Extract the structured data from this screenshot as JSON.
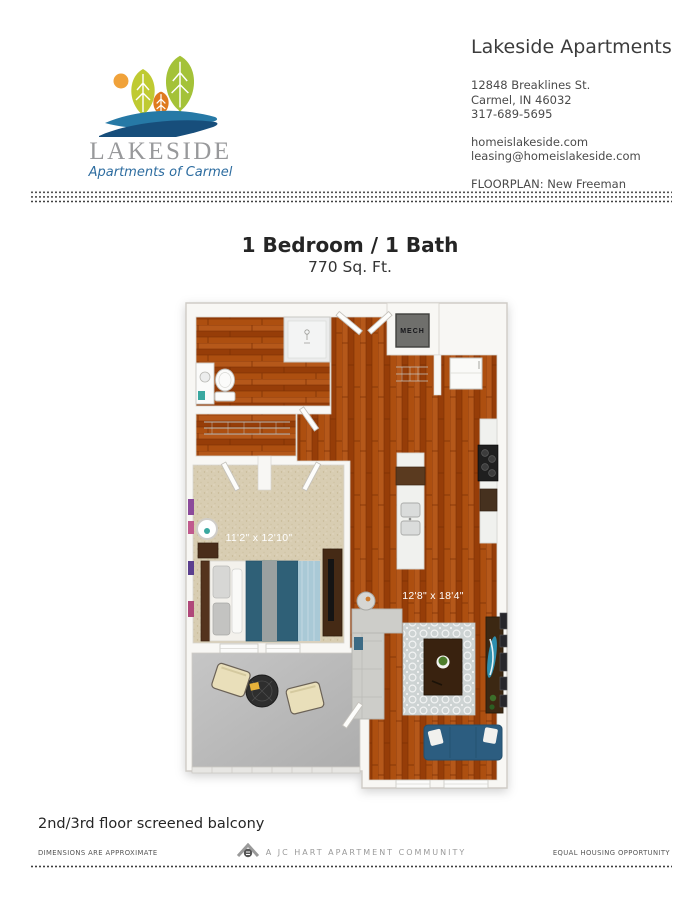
{
  "logo": {
    "name": "LAKESIDE",
    "tagline": "Apartments of Carmel",
    "icons": [
      "sun-icon",
      "tree-icon",
      "wave-icon"
    ],
    "colors": {
      "leaf_green": "#bfca32",
      "leaf_green_dark": "#a4c238",
      "tree_orange": "#df7a1e",
      "sun_orange": "#f0a23a",
      "wave_blue": "#2679a6",
      "wave_navy": "#174e7b",
      "name_gray": "#98999b",
      "tagline_blue": "#2e6da0"
    }
  },
  "header": {
    "company": "Lakeside Apartments",
    "address1": "12848 Breaklines St.",
    "address2": "Carmel, IN 46032",
    "phone": "317-689-5695",
    "website": "homeislakeside.com",
    "email": "leasing@homeislakeside.com",
    "floorplan": "FLOORPLAN: New Freeman"
  },
  "plan": {
    "title": "1 Bedroom / 1 Bath",
    "area": "770 Sq. Ft.",
    "labels": {
      "mech": "MECH",
      "bedroom_dim": "11'2\" x 12'10\"",
      "living_dim": "12'8\" x 18'4\""
    },
    "floor_colors": {
      "wood": "#a64a0e",
      "carpet": "#d8cdb2",
      "balcony": "#bcbcbc",
      "rug": "#cdd3d3",
      "comforter_teal": "#2f6077",
      "sofa_blue": "#2c5d80"
    }
  },
  "notes": {
    "balcony": "2nd/3rd floor screened balcony"
  },
  "footer": {
    "left": "DIMENSIONS ARE APPROXIMATE",
    "center": "A JC HART APARTMENT COMMUNITY",
    "right": "EQUAL HOUSING OPPORTUNITY"
  }
}
